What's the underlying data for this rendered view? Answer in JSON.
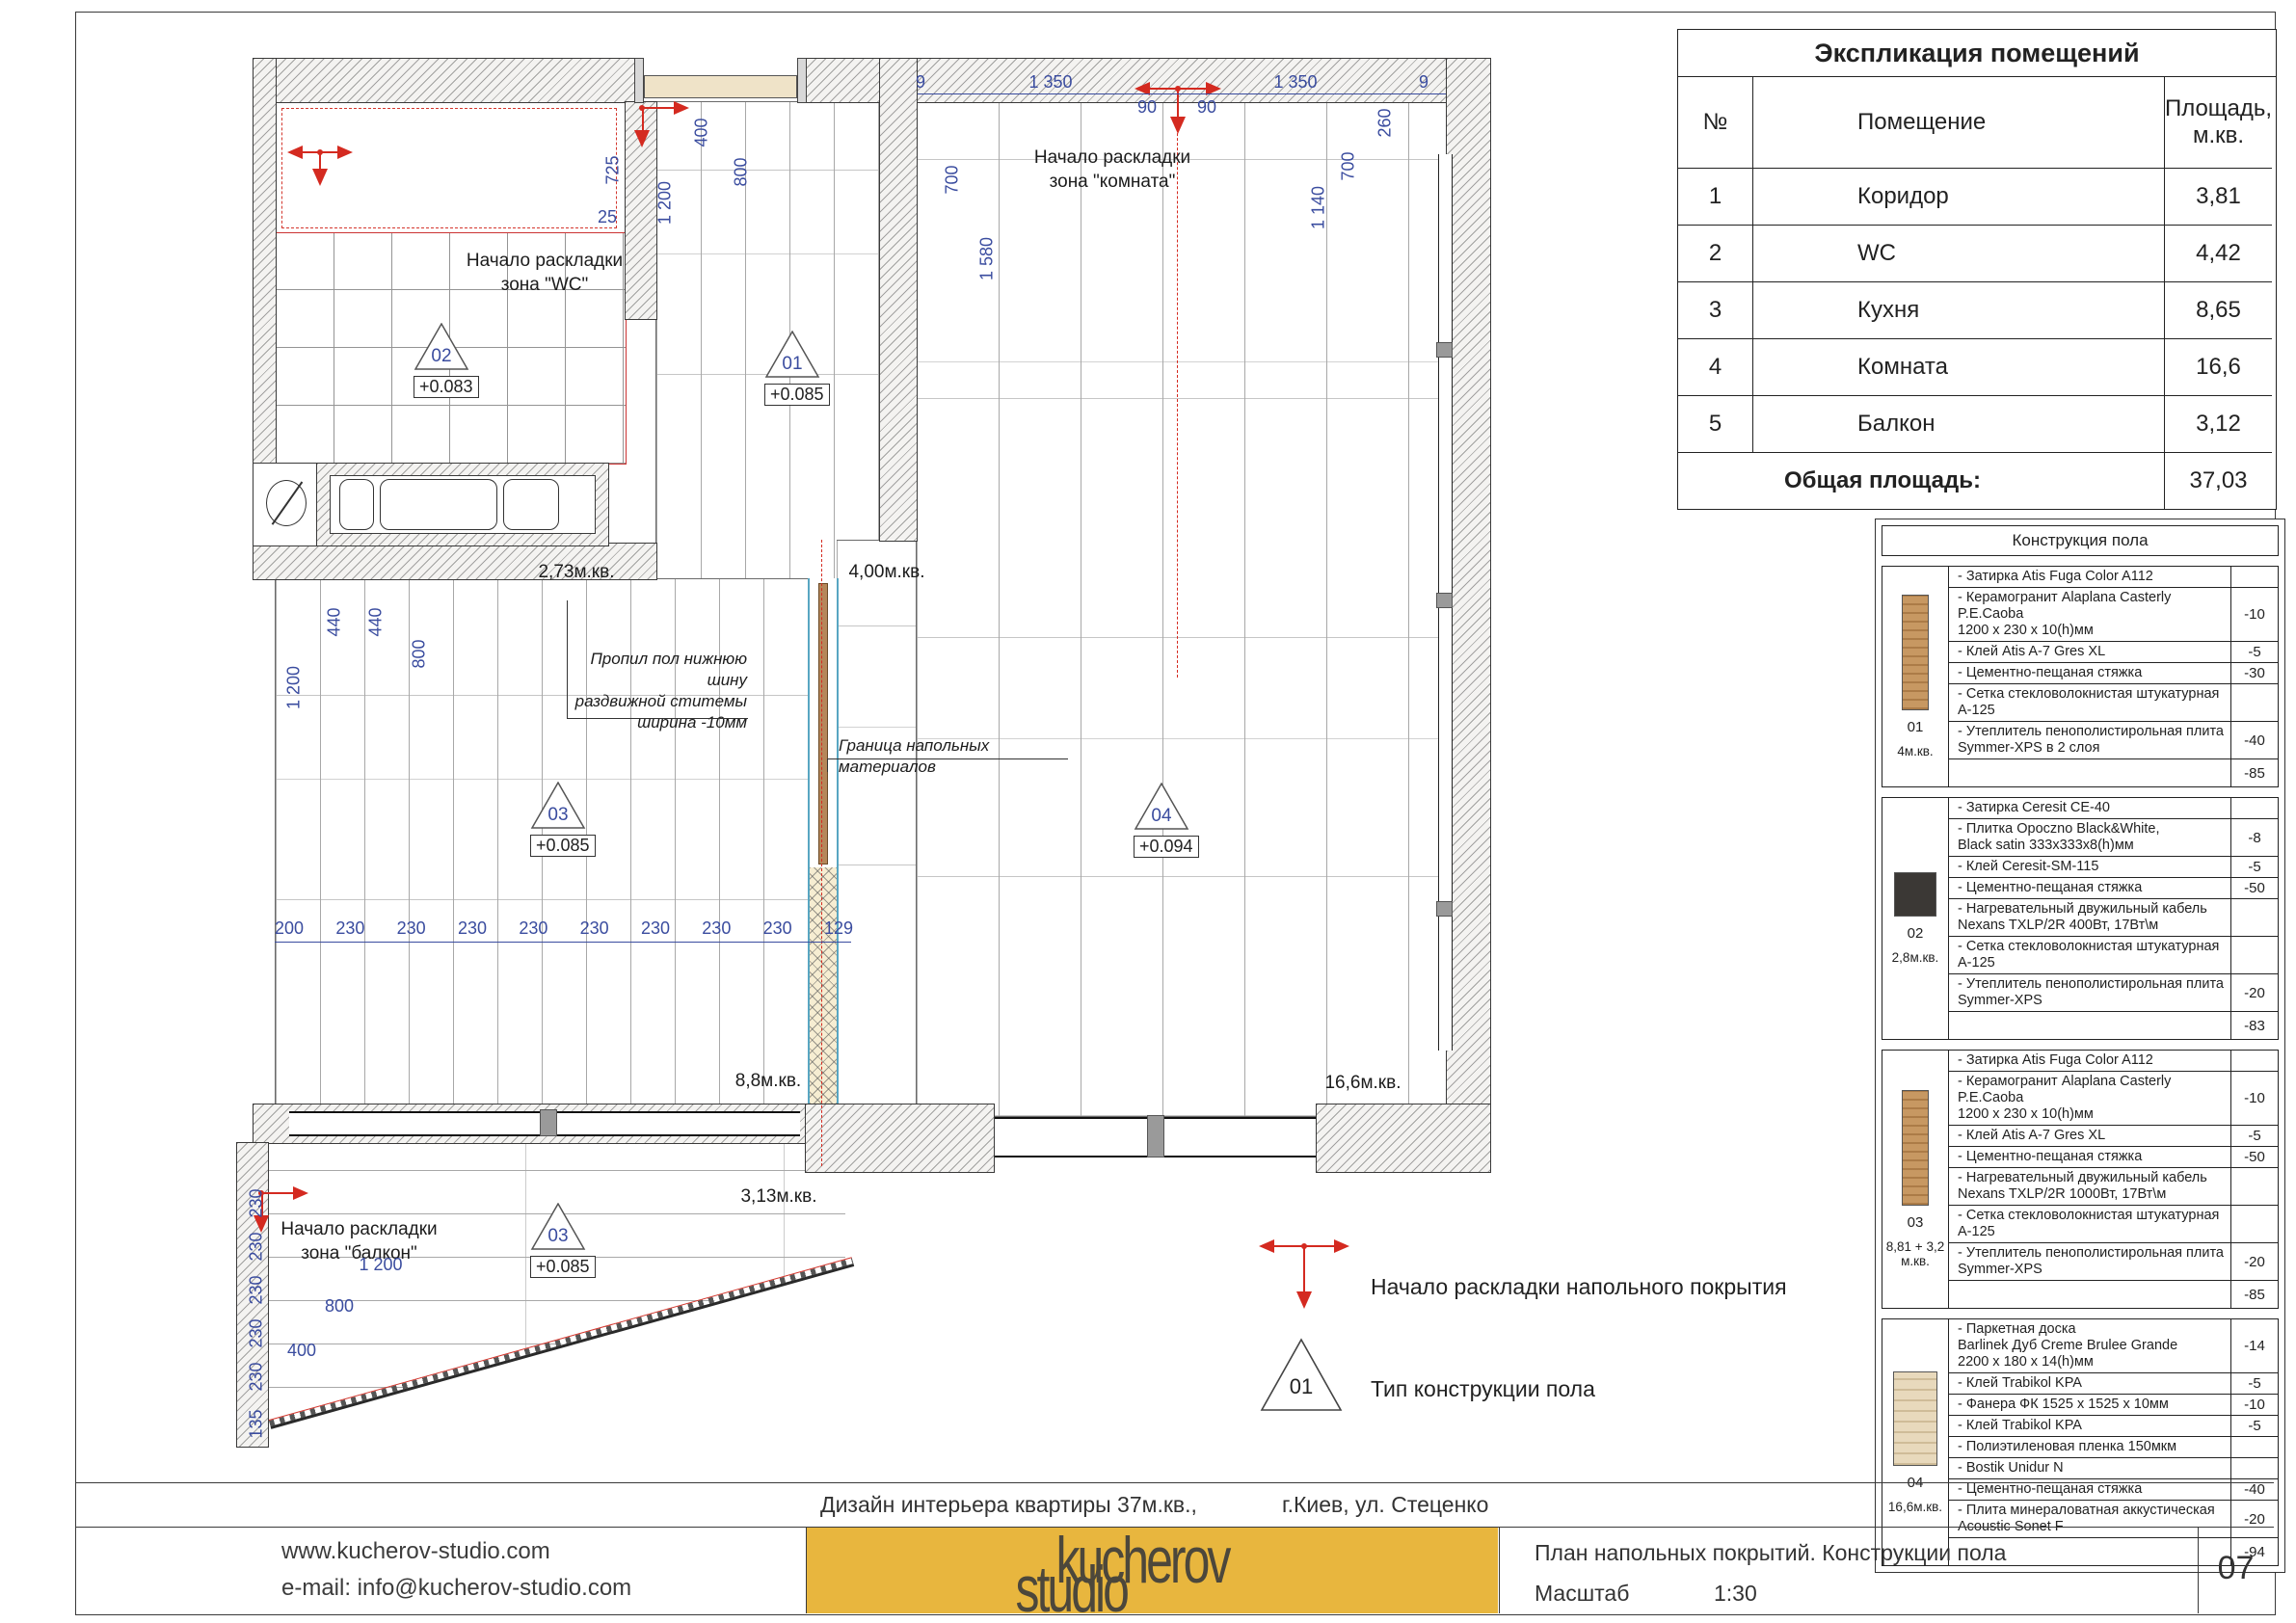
{
  "explication": {
    "title": "Экспликация помещений",
    "columns": {
      "no": "№",
      "room": "Помещение",
      "area": "Площадь,\nм.кв."
    },
    "rows": [
      {
        "no": "1",
        "room": "Коридор",
        "area": "3,81"
      },
      {
        "no": "2",
        "room": "WC",
        "area": "4,42"
      },
      {
        "no": "3",
        "room": "Кухня",
        "area": "8,65"
      },
      {
        "no": "4",
        "room": "Комната",
        "area": "16,6"
      },
      {
        "no": "5",
        "room": "Балкон",
        "area": "3,12"
      }
    ],
    "total_label": "Общая площадь:",
    "total_value": "37,03"
  },
  "construction": {
    "title": "Конструкция пола",
    "sections": [
      {
        "id": "01",
        "area": "4м.кв.",
        "swatch": "wood-dark",
        "rows": [
          {
            "text": "Затирка Atis Fuga Color A112",
            "value": ""
          },
          {
            "text": "Керамогранит Alaplana Casterly P.E.Caoba\n1200 x 230 x 10(h)мм",
            "value": "-10"
          },
          {
            "text": "Клей Atis A-7 Gres XL",
            "value": "-5"
          },
          {
            "text": "Цементно-пещаная стяжка",
            "value": "-30"
          },
          {
            "text": "Сетка стекловолокнистая штукатурная А-125",
            "value": ""
          },
          {
            "text": "Утеплитель пенополистирольная плита\nSymmer-XPS в 2 слоя",
            "value": "-40"
          },
          {
            "text": "",
            "value": "-85"
          }
        ]
      },
      {
        "id": "02",
        "area": "2,8м.кв.",
        "swatch": "tile-black",
        "rows": [
          {
            "text": "Затирка Ceresit CE-40",
            "value": ""
          },
          {
            "text": "Плитка Opoczno Black&White,\nBlack satin 333x333x8(h)мм",
            "value": "-8"
          },
          {
            "text": "Клей Ceresit-SM-115",
            "value": "-5"
          },
          {
            "text": "Цементно-пещаная стяжка",
            "value": "-50"
          },
          {
            "text": "Нагревательный двужильный кабель\nNexans TXLP/2R 400Вт, 17Вт\\м",
            "value": ""
          },
          {
            "text": "Сетка стекловолокнистая штукатурная А-125",
            "value": ""
          },
          {
            "text": "Утеплитель пенополистирольная плита\nSymmer-XPS",
            "value": "-20"
          },
          {
            "text": "",
            "value": "-83"
          }
        ]
      },
      {
        "id": "03",
        "area": "8,81 + 3,2\nм.кв.",
        "swatch": "wood-dark",
        "rows": [
          {
            "text": "Затирка Atis Fuga Color A112",
            "value": ""
          },
          {
            "text": "Керамогранит Alaplana Casterly P.E.Caoba\n1200 x 230 x 10(h)мм",
            "value": "-10"
          },
          {
            "text": "Клей Atis A-7 Gres XL",
            "value": "-5"
          },
          {
            "text": "Цементно-пещаная стяжка",
            "value": "-50"
          },
          {
            "text": "Нагревательный двужильный кабель\nNexans TXLP/2R 1000Вт, 17Вт\\м",
            "value": ""
          },
          {
            "text": "Сетка стекловолокнистая штукатурная А-125",
            "value": ""
          },
          {
            "text": "Утеплитель пенополистирольная плита\nSymmer-XPS",
            "value": "-20"
          },
          {
            "text": "",
            "value": "-85"
          }
        ]
      },
      {
        "id": "04",
        "area": "16,6м.кв.",
        "swatch": "wood-light",
        "rows": [
          {
            "text": "Паркетная доска\nBarlinek Дуб Creme Brulee Grande\n2200 x 180 x 14(h)мм",
            "value": "-14"
          },
          {
            "text": "Клей Trabikol KPA",
            "value": "-5"
          },
          {
            "text": "Фанера ФК 1525 x 1525 x 10мм",
            "value": "-10"
          },
          {
            "text": "Клей Trabikol KPA",
            "value": "-5"
          },
          {
            "text": "Полиэтиленовая пленка 150мкм",
            "value": ""
          },
          {
            "text": "Bostik Unidur N",
            "value": ""
          },
          {
            "text": "Цементно-пещаная стяжка",
            "value": "-40"
          },
          {
            "text": "Плита минераловатная аккустическая\nAcoustic Sonet F",
            "value": "-20"
          },
          {
            "text": "",
            "value": "-94"
          }
        ]
      }
    ]
  },
  "legend": {
    "start_label": "Начало раскладки напольного покрытия",
    "type_label": "Тип конструкции пола",
    "type_number": "01"
  },
  "plan": {
    "zones": {
      "wc": "Начало раскладки\nзона \"WC\"",
      "room": "Начало раскладки\nзона \"комната\"",
      "balcony": "Начало раскладки\nзона \"балкон\""
    },
    "areas": {
      "wc": "2,73м.кв.",
      "corridor": "4,00м.кв.",
      "kitchen": "8,8м.кв.",
      "room": "16,6м.кв.",
      "balcony": "3,13м.кв."
    },
    "markers": {
      "wc": {
        "num": "02",
        "elev": "+0.083"
      },
      "corridor": {
        "num": "01",
        "elev": "+0.085"
      },
      "kitchen": {
        "num": "03",
        "elev": "+0.085"
      },
      "room": {
        "num": "04",
        "elev": "+0.094"
      },
      "balcony": {
        "num": "03",
        "elev": "+0.085"
      }
    },
    "notes": {
      "cut": "Пропил пол нижнюю шину\nраздвижной ститемы\nширина -10мм",
      "boundary": "Граница напольных материалов"
    },
    "dims": {
      "top": [
        "9",
        "1 350",
        "90",
        "90",
        "1 350",
        "9"
      ],
      "corridor": [
        "400",
        "800",
        "1 200"
      ],
      "wc": [
        "725",
        "25"
      ],
      "room_left": [
        "700",
        "1 580"
      ],
      "room_right": [
        "260",
        "700",
        "1 140"
      ],
      "kitchen": [
        "1 200",
        "440",
        "440",
        "800"
      ],
      "bottom": [
        "200",
        "230",
        "230",
        "230",
        "230",
        "230",
        "230",
        "230",
        "230",
        "129"
      ],
      "balcony": [
        "1 200",
        "800",
        "400"
      ],
      "balcony_left": [
        "230",
        "230",
        "230",
        "230",
        "230",
        "135"
      ]
    }
  },
  "titleblock": {
    "project": "Дизайн интерьера квартиры 37м.кв.,",
    "address": "г.Киев, ул. Стеценко",
    "website": "www.kucherov-studio.com",
    "email": "e-mail: info@kucherov-studio.com",
    "logo_top": "kucherov",
    "logo_bottom": "studio",
    "sheet_title": "План напольных покрытий. Конструкции пола",
    "scale_label": "Масштаб",
    "scale_value": "1:30",
    "page": "07"
  }
}
